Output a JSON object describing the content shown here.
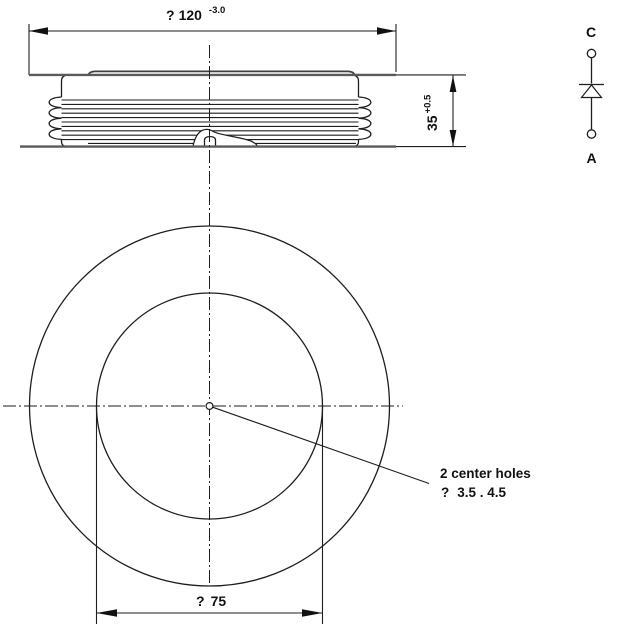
{
  "side_view": {
    "dim_diameter": {
      "symbol": "?",
      "value": "120",
      "tolerance": "-3.0"
    },
    "dim_height": {
      "value": "35",
      "tolerance": "+0.5"
    }
  },
  "plan_view": {
    "dim_center_circle": {
      "symbol": "?",
      "value": "75"
    },
    "note": {
      "line1": "2 center holes",
      "symbol": "?",
      "value": "3.5 . 4.5"
    }
  },
  "circuit_symbol": {
    "cathode_label": "C",
    "anode_label": "A"
  },
  "colors": {
    "line": "#1e1e1e",
    "thick_line": "#5a5a5a",
    "text": "#111111",
    "background": "#ffffff"
  }
}
